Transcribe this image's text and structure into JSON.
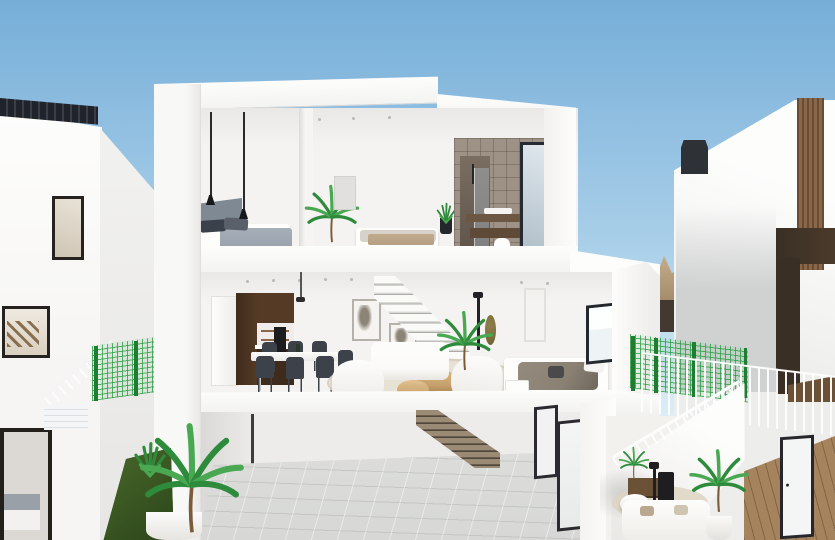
{
  "meta": {
    "title": "3D architectural cutaway render of a modern three-storey white villa between two neighbouring houses under a clear blue sky",
    "render_width": 835,
    "render_height": 540
  },
  "colors": {
    "sky_top": "#76aed8",
    "sky_mid": "#a9cfe9",
    "sky_horizon": "#ddeef7",
    "white_wall": "#f6f5f3",
    "white_bright": "#fdfdfc",
    "wall_shade": "#e9e8e6",
    "wall_shade2": "#dcdbd8",
    "slab_shadow": "#c6c6c3",
    "interior_wall": "#f4f3f1",
    "gray_face": "#cfd2d1",
    "walnut": "#553a26",
    "walnut_dark": "#3f2b1c",
    "oven_black": "#1c1c1e",
    "frame_dark": "#26262c",
    "glass_light": "#eef3f6",
    "glass_warm": "#cfc5b4",
    "headboard_gray": "#7f8994",
    "duvet_gray": "#98a1ab",
    "pillow_dark": "#3b414a",
    "duvet_taupe": "#8a8174",
    "bench_beige": "#b5a084",
    "stone_tile": "#9e9287",
    "shower_dark": "#5f544a",
    "vanity_wood": "#6e5742",
    "rug_beige": "#e7e1d3",
    "coffee_wood": "#c8a26e",
    "sofa_white": "#fbfaf8",
    "art_smudge": "#8d8478",
    "olive": "#8f7f4e",
    "lamp_black": "#1f1f21",
    "plant_green": "#2e8b3c",
    "plant_light": "#49a851",
    "trunk_brown": "#7a5b3a",
    "fence_green": "#2f9e44",
    "fence_post": "#1f7c33",
    "grass_green": "#3a5a22",
    "mountain_tan": "#c9b291",
    "mountain_dark": "#9c8263",
    "hedge_brown": "#443931",
    "chimney_dark": "#2e3237",
    "wood_strip": "#8a6748",
    "brown_panel": "#3a2f25",
    "brown_band": "#4a3a2b",
    "wood_floor": "#a5835c",
    "wood_floor_dark": "#6b5136",
    "stair_wood": "#9b8a74",
    "stair_shadow": "#4f463c",
    "floor_tile": "#d7d8d6",
    "chair_dark": "#3d424a",
    "steel": "#b9b9b6"
  },
  "scene": {
    "sky": {
      "label": "Clear blue sky, paler toward the horizon"
    },
    "mountains": {
      "label": "Tan rocky hillside visible between the houses"
    },
    "left_building": {
      "label": "Neighbouring white house (left)",
      "features": [
        "dark roof slat panel",
        "tall dark-framed window",
        "stairwell window with timber stairs",
        "lower bedroom window",
        "exterior stair with thin railing",
        "green mesh garden fence",
        "sloped grass verge with agave",
        "potted palm in the alley"
      ]
    },
    "right_building": {
      "label": "Neighbouring white house (right)",
      "features": [
        "dark chimney",
        "vertical timber-clad edge",
        "dark brown feature panels",
        "white exterior staircase with solid balustrade",
        "green mesh fence",
        "white slat railing",
        "terrace lounge with white sofa, round table, black lamp and palms",
        "timber-floored hallway with dark-framed glazed door"
      ]
    },
    "main_villa": {
      "label": "Cutaway section of the three-storey villa",
      "floors": [
        {
          "name": "Upper floor",
          "rooms": [
            {
              "name": "Bedroom 1",
              "items": [
                "grey upholstered headboard",
                "double bed with grey duvet and dark pillows",
                "two black pendant lights"
              ]
            },
            {
              "name": "Bedroom 2",
              "items": [
                "double bed with beige bench",
                "grey wardrobe door",
                "black potted plant",
                "white wall sconce"
              ]
            },
            {
              "name": "Bathroom",
              "items": [
                "stone-tiled walls",
                "dark shower niche with glass screen",
                "floating timber vanity",
                "dark-framed window"
              ]
            }
          ],
          "extra": "potted palm beside the partition wall"
        },
        {
          "name": "Ground floor",
          "rooms": [
            {
              "name": "Kitchen",
              "items": [
                "white fridge column",
                "walnut cabinetry",
                "black oven column",
                "open shelves",
                "white countertop"
              ]
            },
            {
              "name": "Dining area",
              "items": [
                "white table",
                "six dark chairs",
                "slim pendant light"
              ]
            },
            {
              "name": "Living room",
              "items": [
                "white modular sofa",
                "white armchair and chaise",
                "two round timber coffee tables",
                "jute rug",
                "two botanical wall prints",
                "floating white staircase",
                "black floor lamp",
                "olive round mirror",
                "indoor palm"
              ]
            },
            {
              "name": "Bed nook",
              "items": [
                "bed with taupe throw",
                "white side table",
                "white door",
                "dark-framed window"
              ]
            }
          ]
        },
        {
          "name": "Basement garage",
          "rooms": [
            {
              "name": "Garage",
              "items": [
                "grey tiled floor",
                "timber stair descending from ground floor",
                "two dark-framed glazed doors",
                "slim service pipe"
              ]
            }
          ]
        }
      ]
    }
  }
}
